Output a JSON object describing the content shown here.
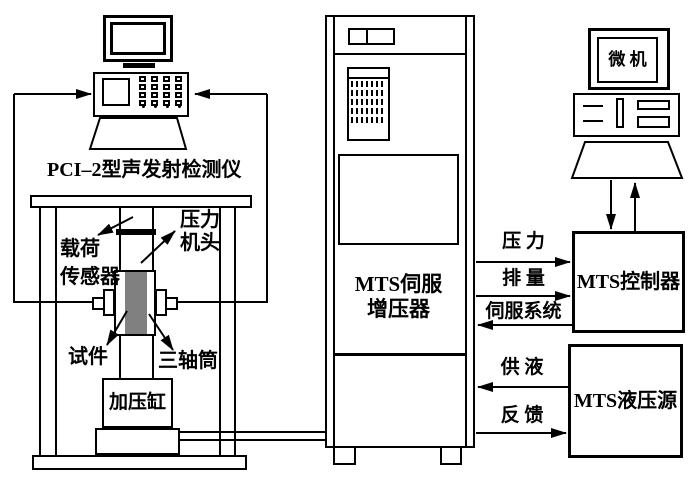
{
  "colors": {
    "line": "#000000",
    "specimen": "#808080",
    "background": "#ffffff"
  },
  "ae_station": {
    "label": "PCI–2型声发射检测仪"
  },
  "frame": {
    "load_sensor_line1": "载荷",
    "load_sensor_line2": "传感器",
    "press_head_line1": "压力",
    "press_head_line2": "机头",
    "specimen": "试件",
    "triaxial_cell": "三轴筒",
    "pressure_cylinder": "加压缸"
  },
  "booster": {
    "line1": "MTS伺服",
    "line2": "增压器"
  },
  "computer": {
    "label": "微 机"
  },
  "controller": {
    "label": "MTS控制器"
  },
  "hydraulic": {
    "label": "MTS液压源"
  },
  "signals": {
    "pressure": "压 力",
    "displacement": "排 量",
    "servo": "伺服系统",
    "supply": "供 液",
    "feedback": "反 馈"
  }
}
